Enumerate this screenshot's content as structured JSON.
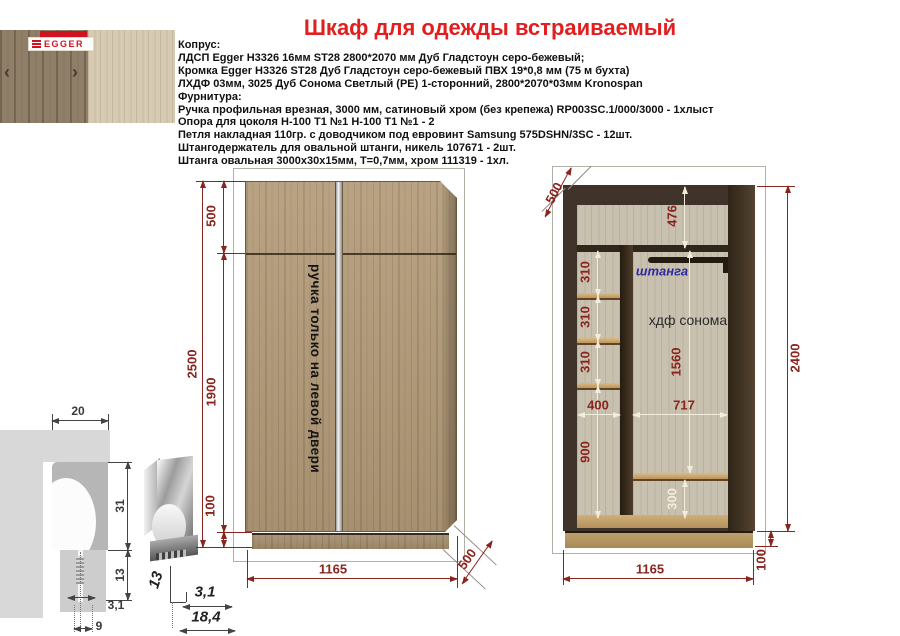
{
  "title": "Шкаф для одежды встраиваемый",
  "samples": {
    "brand": "EGGER",
    "prev_icon": "‹",
    "next_icon": "›"
  },
  "specs": {
    "lines": [
      "Копрус:",
      "ЛДСП Egger Н3326 16мм ST28 2800*2070 мм Дуб Гладстоун серо-бежевый;",
      "Кромка Egger Н3326 ST28 Дуб Гладстоун серо-бежевый ПВХ 19*0,8 мм (75 м бухта)",
      "ЛХДФ 03мм, 3025 Дуб Сонома Светлый (РЕ) 1-сторонний, 2800*2070*03мм Kronospan",
      "Фурнитура:",
      "Ручка профильная врезная, 3000 мм, сатиновый хром (без крепежа) RP003SC.1/000/3000 - 1хлыст",
      "Опора для цоколя Н-100 Т1 №1 Н-100 Т1 №1 - 2",
      "Петля накладная 110гр. с доводчиком под евровинт Samsung 575DSHN/3SC - 12шт.",
      "Штангодержатель для овальной штанги, никель 107671 - 2шт.",
      "Штанга овальная 3000х30х15мм, Т=0,7мм, хром 111319 - 1хл."
    ]
  },
  "front_view": {
    "door_note": "ручка только на левой двери",
    "dims": {
      "total_height": "2500",
      "top_section": "500",
      "doors_height": "1900",
      "plinth_height": "100",
      "width": "1165",
      "depth": "500"
    }
  },
  "interior_view": {
    "rod_label": "штанга",
    "back_label": "хдф сонома",
    "dims": {
      "depth": "500",
      "top_section": "476",
      "shelf_gap": "310",
      "rod_section": "1560",
      "left_width": "400",
      "right_width": "717",
      "left_lower": "900",
      "bottom_shelf": "300",
      "height": "2400",
      "width": "1165",
      "plinth_height": "100"
    }
  },
  "handle": {
    "dims": {
      "top_width": "20",
      "body_height": "31",
      "insert": "13",
      "slot": "3,1",
      "base": "9",
      "profile_height": "13",
      "profile_slot": "3,1",
      "profile_width": "18,4"
    }
  }
}
